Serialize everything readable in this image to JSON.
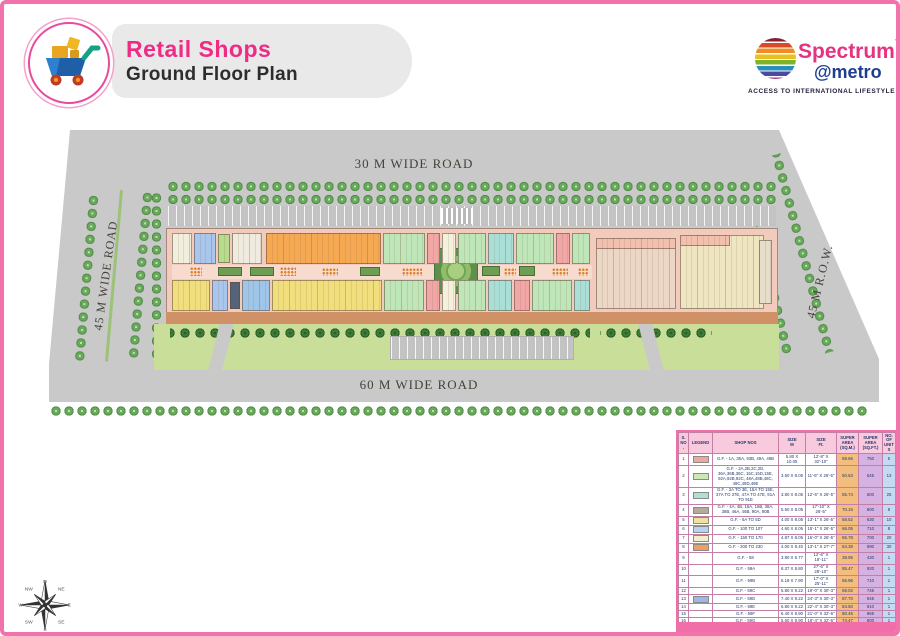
{
  "header": {
    "title": "Retail Shops",
    "subtitle": "Ground Floor Plan",
    "brand": {
      "name_primary": "Spectrum",
      "tm": "TM",
      "name_secondary": "@metro",
      "tagline": "ACCESS TO INTERNATIONAL LIFESTYLE"
    }
  },
  "plan": {
    "road_labels": {
      "top": "30 M WIDE ROAD",
      "bottom": "60 M WIDE ROAD",
      "left": "45 M WIDE ROAD",
      "right": "45 M R.O.W."
    },
    "anchor_labels": {
      "dep_a": "DEP.-A",
      "dep_b": "DEP.-B",
      "dep_b_sub": "DEPARTMENTAL STORE"
    },
    "colors": {
      "mall_base": "#f3cbbc",
      "road": "#c9c9c9",
      "lawn": "#c9de98",
      "orange_block": "#f5a952",
      "yellow_block": "#f1df7d",
      "blue_block": "#a9c6ec",
      "green_block": "#bfe6b8",
      "cyan_block": "#aadfd8",
      "red_block": "#f2a7a7"
    },
    "shop_blocks": [
      {
        "x": 168,
        "y": 229,
        "w": 20,
        "h": 31,
        "c": "#f2eedd"
      },
      {
        "x": 190,
        "y": 229,
        "w": 22,
        "h": 31,
        "c": "#a9c6ec"
      },
      {
        "x": 214,
        "y": 230,
        "w": 12,
        "h": 29,
        "c": "#b8dc8e"
      },
      {
        "x": 228,
        "y": 229,
        "w": 30,
        "h": 31,
        "c": "#efecdf"
      },
      {
        "x": 262,
        "y": 229,
        "w": 115,
        "h": 31,
        "c": "#f5a952"
      },
      {
        "x": 379,
        "y": 229,
        "w": 42,
        "h": 31,
        "c": "#bfe6b8"
      },
      {
        "x": 423,
        "y": 229,
        "w": 13,
        "h": 31,
        "c": "#f2a7a7"
      },
      {
        "x": 438,
        "y": 229,
        "w": 14,
        "h": 31,
        "c": "#f4f0db"
      },
      {
        "x": 454,
        "y": 229,
        "w": 28,
        "h": 31,
        "c": "#bfe6b8"
      },
      {
        "x": 484,
        "y": 229,
        "w": 26,
        "h": 31,
        "c": "#aadfd8"
      },
      {
        "x": 512,
        "y": 229,
        "w": 38,
        "h": 31,
        "c": "#bfe6b8"
      },
      {
        "x": 552,
        "y": 229,
        "w": 14,
        "h": 31,
        "c": "#f2a7a7"
      },
      {
        "x": 568,
        "y": 229,
        "w": 18,
        "h": 31,
        "c": "#bfe6b8"
      },
      {
        "x": 168,
        "y": 276,
        "w": 38,
        "h": 31,
        "c": "#f1df7d"
      },
      {
        "x": 208,
        "y": 276,
        "w": 16,
        "h": 31,
        "c": "#a9c6ec"
      },
      {
        "x": 226,
        "y": 278,
        "w": 10,
        "h": 27,
        "c": "#53637a"
      },
      {
        "x": 238,
        "y": 276,
        "w": 28,
        "h": 31,
        "c": "#9fc6e8"
      },
      {
        "x": 268,
        "y": 276,
        "w": 110,
        "h": 31,
        "c": "#f1df7d"
      },
      {
        "x": 380,
        "y": 276,
        "w": 40,
        "h": 31,
        "c": "#bfe6b8"
      },
      {
        "x": 422,
        "y": 276,
        "w": 14,
        "h": 31,
        "c": "#f2a7a7"
      },
      {
        "x": 438,
        "y": 276,
        "w": 14,
        "h": 31,
        "c": "#f4f0db"
      },
      {
        "x": 454,
        "y": 276,
        "w": 28,
        "h": 31,
        "c": "#bfe6b8"
      },
      {
        "x": 484,
        "y": 276,
        "w": 24,
        "h": 31,
        "c": "#aadfd8"
      },
      {
        "x": 510,
        "y": 276,
        "w": 16,
        "h": 31,
        "c": "#f2a7a7"
      },
      {
        "x": 528,
        "y": 276,
        "w": 40,
        "h": 31,
        "c": "#bfe6b8"
      },
      {
        "x": 570,
        "y": 276,
        "w": 16,
        "h": 31,
        "c": "#aadfd8"
      },
      {
        "x": 592,
        "y": 234,
        "w": 80,
        "h": 71,
        "c": "#ecd7c6"
      },
      {
        "x": 592,
        "y": 234,
        "w": 80,
        "h": 11,
        "c": "#f2c0ae"
      },
      {
        "x": 676,
        "y": 231,
        "w": 84,
        "h": 74,
        "c": "#efe5c0"
      },
      {
        "x": 676,
        "y": 231,
        "w": 50,
        "h": 11,
        "c": "#f2c0ae"
      },
      {
        "x": 755,
        "y": 236,
        "w": 13,
        "h": 64,
        "c": "#e7ddcb"
      }
    ],
    "planters": [
      {
        "x": 214,
        "y": 263,
        "w": 24,
        "h": 9
      },
      {
        "x": 246,
        "y": 263,
        "w": 24,
        "h": 9
      },
      {
        "x": 356,
        "y": 263,
        "w": 20,
        "h": 9
      },
      {
        "x": 478,
        "y": 262,
        "w": 18,
        "h": 10
      },
      {
        "x": 515,
        "y": 262,
        "w": 16,
        "h": 10
      }
    ],
    "seats": [
      {
        "x": 186,
        "y": 263,
        "w": 12,
        "h": 9
      },
      {
        "x": 276,
        "y": 263,
        "w": 16,
        "h": 9
      },
      {
        "x": 318,
        "y": 264,
        "w": 16,
        "h": 8
      },
      {
        "x": 398,
        "y": 264,
        "w": 20,
        "h": 8
      },
      {
        "x": 500,
        "y": 264,
        "w": 12,
        "h": 8
      },
      {
        "x": 548,
        "y": 264,
        "w": 16,
        "h": 8
      },
      {
        "x": 574,
        "y": 264,
        "w": 10,
        "h": 8
      }
    ]
  },
  "compass": {
    "points": [
      "N",
      "NE",
      "E",
      "SE",
      "S",
      "SW",
      "W",
      "NW"
    ]
  },
  "legend_table": {
    "headers": [
      {
        "t": "S.",
        "s": "NO."
      },
      {
        "t": "LEGEND",
        "s": ""
      },
      {
        "t": "SHOP NOS",
        "s": ""
      },
      {
        "t": "SIZE",
        "s": "M"
      },
      {
        "t": "SIZE",
        "s": "Ft."
      },
      {
        "t": "SUPER AREA",
        "s": "(SQ.M.)"
      },
      {
        "t": "SUPER AREA",
        "s": "(SQ.FT.)"
      },
      {
        "t": "NO. OF",
        "s": "UNITS"
      }
    ],
    "rows": [
      {
        "no": "1",
        "color": "#eda89d",
        "shops": "G.F. - 1A, 35A, 93B, 49A, 49B",
        "size_m": "5.80 X 10.05",
        "size_ft": "12'-8\" X 32'-10\"",
        "area_m": "69.66",
        "area_ft": "750",
        "units": "5"
      },
      {
        "no": "2",
        "color": "#cbe7b5",
        "shops": "G.F. - 2A,2B,2C,2D, 36A,36B,36C, 15C,15D,15E, 92A,92B,92C, 48A,48B,48C, 49C,49D,49E",
        "size_m": "3.50 X 8.05",
        "size_ft": "11'-6\" X 26'-5\"",
        "area_m": "50.63",
        "area_ft": "545",
        "units": "13"
      },
      {
        "no": "3",
        "color": "#aee0d6",
        "shops": "G.F. - 3A TO 3E, 15A TO 15E, 37A TO 37E, 47A TO 47E, 91A TO 91E",
        "size_m": "3.80 X 8.05",
        "size_ft": "12'-6\" X 26'-5\"",
        "area_m": "55.74",
        "area_ft": "600",
        "units": "25"
      },
      {
        "no": "4",
        "color": "#b5ab9d",
        "shops": "G.F. - 4A, 4B, 16A, 16B, 38A, 38B, 46A, 46B, 90A, 90B",
        "size_m": "5.50 X 8.05",
        "size_ft": "17'-10\" X 26'-5\"",
        "area_m": "70.16",
        "area_ft": "800",
        "units": "8"
      },
      {
        "no": "5",
        "color": "#ede39f",
        "shops": "G.F. - 5A TO 5D",
        "size_m": "4.00 X 8.05",
        "size_ft": "13'-1\" X 26'-5\"",
        "area_m": "58.52",
        "area_ft": "630",
        "units": "10"
      },
      {
        "no": "6",
        "color": "#b9d2f0",
        "shops": "G.F. - 100 TO 107",
        "size_m": "4.60 X 8.05",
        "size_ft": "15'-1\" X 26'-5\"",
        "area_m": "66.05",
        "area_ft": "710",
        "units": "8"
      },
      {
        "no": "7",
        "color": "#f2eecb",
        "shops": "G.F. - 150 TO 170",
        "size_m": "4.87 X 8.05",
        "size_ft": "16'-0\" X 26'-5\"",
        "area_m": "65.78",
        "area_ft": "700",
        "units": "20"
      },
      {
        "no": "8",
        "color": "#efa05c",
        "shops": "G.F. - 200 TO 230",
        "size_m": "4.00 X 8.40",
        "size_ft": "13'-1\" X 27'-7\"",
        "area_m": "64.38",
        "area_ft": "690",
        "units": "30"
      },
      {
        "no": "9",
        "color": "",
        "shops": "G.F. - 58",
        "size_m": "3.80 X 5.77",
        "size_ft": "12'-6\" X 18'-11\"",
        "area_m": "39.95",
        "area_ft": "430",
        "units": "1"
      },
      {
        "no": "10",
        "color": "",
        "shops": "G.F. - 59A",
        "size_m": "8.37 X 8.80",
        "size_ft": "27'-6\" X 28'-10\"",
        "area_m": "85.47",
        "area_ft": "920",
        "units": "1"
      },
      {
        "no": "11",
        "color": "",
        "shops": "G.F. - 59B",
        "size_m": "5.18 X 7.90",
        "size_ft": "17'-0\" X 25'-11\"",
        "area_m": "65.96",
        "area_ft": "710",
        "units": "1"
      },
      {
        "no": "12",
        "color": "",
        "shops": "G.F. - 59C",
        "size_m": "5.80 X 9.22",
        "size_ft": "19'-0\" X 30'-3\"",
        "area_m": "69.02",
        "area_ft": "745",
        "units": "1"
      },
      {
        "no": "13",
        "color": "#9fb6e8",
        "shops": "G.F. - 59D",
        "size_m": "7.40 X 9.22",
        "size_ft": "24'-3\" X 30'-3\"",
        "area_m": "87.70",
        "area_ft": "945",
        "units": "1"
      },
      {
        "no": "14",
        "color": "",
        "shops": "G.F. - 59E",
        "size_m": "6.80 X 9.22",
        "size_ft": "22'-4\" X 30'-3\"",
        "area_m": "84.50",
        "area_ft": "910",
        "units": "1"
      },
      {
        "no": "15",
        "color": "",
        "shops": "G.F. - 59F",
        "size_m": "6.40 X 9.90",
        "size_ft": "21'-0\" X 32'-6\"",
        "area_m": "80.45",
        "area_ft": "865",
        "units": "1"
      },
      {
        "no": "16",
        "color": "",
        "shops": "G.F. - 59G",
        "size_m": "5.60 X 9.90",
        "size_ft": "18'-4\" X 32'-6\"",
        "area_m": "74.47",
        "area_ft": "800",
        "units": "1"
      },
      {
        "no": "17",
        "color": "",
        "shops": "G.F. - 60",
        "size_m": "6.40 X 10.66",
        "size_ft": "21'-0\" X 35'-0\"",
        "area_m": "77.57",
        "area_ft": "835",
        "units": "1"
      },
      {
        "no": "18",
        "color": "#e9e9c9",
        "shops": "G.F. - 61",
        "size_merge": "DEP. STORE A",
        "area_m": "1612.35",
        "area_ft": "17355",
        "units": "1"
      },
      {
        "no": "19",
        "color": "#cfc3a0",
        "shops": "G.F. - 62",
        "size_merge": "DEP. STORE B",
        "area_m": "1562.57",
        "area_ft": "16820",
        "units": "1"
      }
    ],
    "total_label": "TOTAL",
    "total_units": "130"
  }
}
